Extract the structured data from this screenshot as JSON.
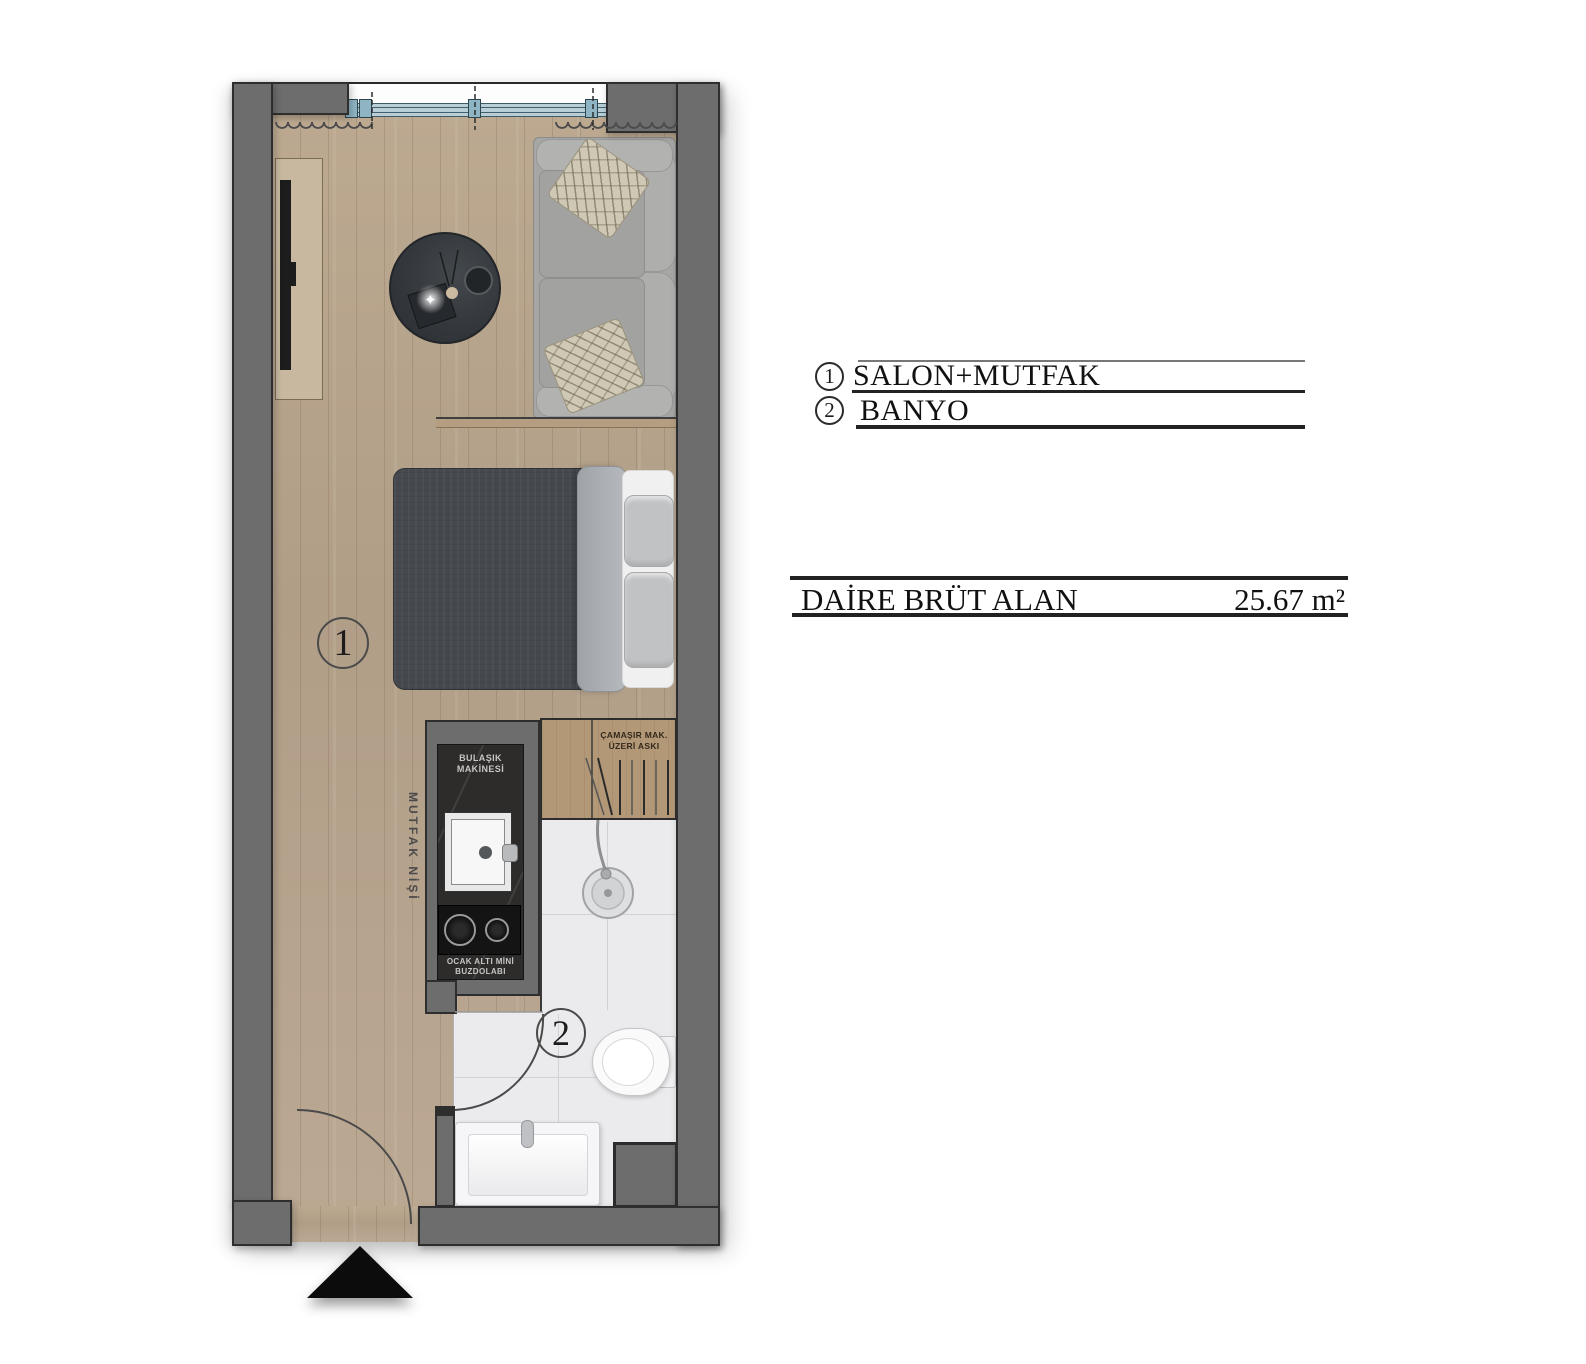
{
  "plan": {
    "room_labels": {
      "salon": "1",
      "banyo": "2"
    },
    "annotations": {
      "mutfak_nisi": "MUTFAK NİŞİ",
      "bulasik": "BULAŞIK\nMAKİNESİ",
      "ocak": "OCAK ALTI MİNİ\nBUZDOLABI",
      "camasir": "ÇAMAŞIR MAK.\nÜZERİ ASKI"
    },
    "decor": {
      "sparkle_icon": "✦"
    }
  },
  "legend": {
    "items": [
      {
        "number": "1",
        "label": "SALON+MUTFAK"
      },
      {
        "number": "2",
        "label": "BANYO"
      }
    ]
  },
  "area_table": {
    "label": "DAİRE BRÜT ALAN",
    "value": "25.67 m²"
  },
  "colors": {
    "wall": "#6d6d6d",
    "floor_wood": "#b7a48e",
    "bathroom_tile": "#ebebed",
    "window_frame": "#8fb5c4",
    "counter_dark": "#2d2c2b",
    "arrow_black": "#0c0c0c"
  }
}
